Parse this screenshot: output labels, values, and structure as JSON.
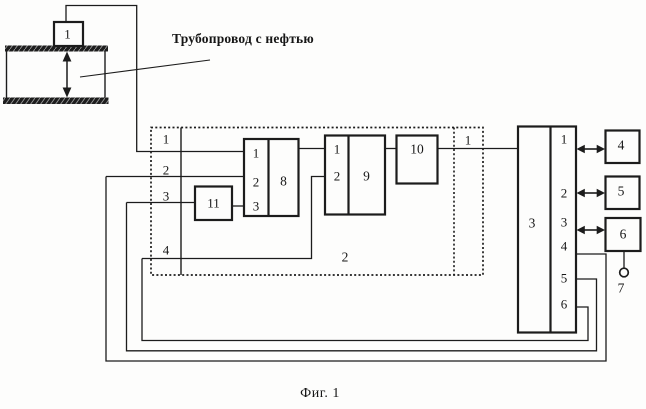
{
  "figure": {
    "caption": "Фиг. 1",
    "pipeline_label": "Трубопровод с нефтью"
  },
  "pipeline": {
    "sensor_label": "1"
  },
  "unit2": {
    "label": "2",
    "left_ports": [
      "1",
      "2",
      "3",
      "4"
    ],
    "right_port": "1",
    "block11": {
      "label": "11"
    },
    "block8": {
      "label": "8",
      "ports": [
        "1",
        "2",
        "3"
      ]
    },
    "block9": {
      "label": "9",
      "ports": [
        "1",
        "2"
      ]
    },
    "block10": {
      "label": "10"
    }
  },
  "block3": {
    "label": "3",
    "ports": [
      "1",
      "2",
      "3",
      "4",
      "5",
      "6"
    ]
  },
  "peripherals": {
    "block4": "4",
    "block5": "5",
    "block6": "6",
    "terminal7": "7"
  }
}
